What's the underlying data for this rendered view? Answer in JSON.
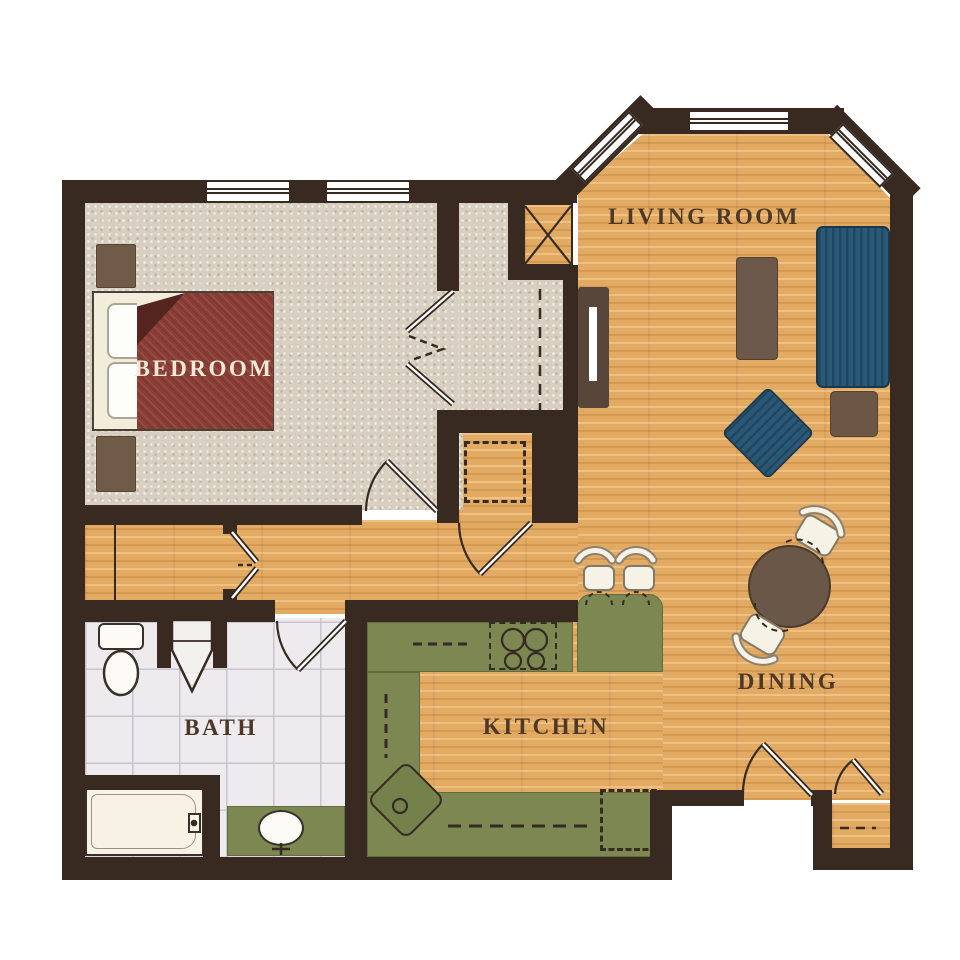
{
  "title": "One-Bedroom Apartment Floor Plan",
  "rooms": {
    "bedroom": {
      "label": "BEDROOM"
    },
    "living_room": {
      "label": "LIVING ROOM"
    },
    "bath": {
      "label": "BATH"
    },
    "kitchen": {
      "label": "KITCHEN"
    },
    "dining": {
      "label": "DINING"
    }
  },
  "colors": {
    "bg": "#ffffff",
    "wall": "#382a21",
    "line": "#352b22",
    "label": "#4d3926",
    "wood": "#e3aa64",
    "carpet": "#d8cfc1",
    "tile": "#edebee",
    "tile-line": "#c9c5cc",
    "counter": "#7c8751",
    "counter-edge": "#626d3e",
    "sink-green": "#75814b",
    "sofa": "#2b5874",
    "sofa-stripe": "#1e4763",
    "blanket": "#8a3e35",
    "blanket-dark": "#54251f",
    "cream": "#f2ecda",
    "pillow": "#fdfdfa",
    "bedroom-text": "#f2e9d7",
    "table-brown": "#6a5747",
    "coffee-brown": "#6d594b",
    "end-brown": "#6c5646",
    "night-brown": "#6f5b48",
    "tv-brown": "#574639",
    "seat": "#f6f2e6",
    "seat-edge": "#817a6a",
    "fixture-white": "#fbfaf5"
  }
}
